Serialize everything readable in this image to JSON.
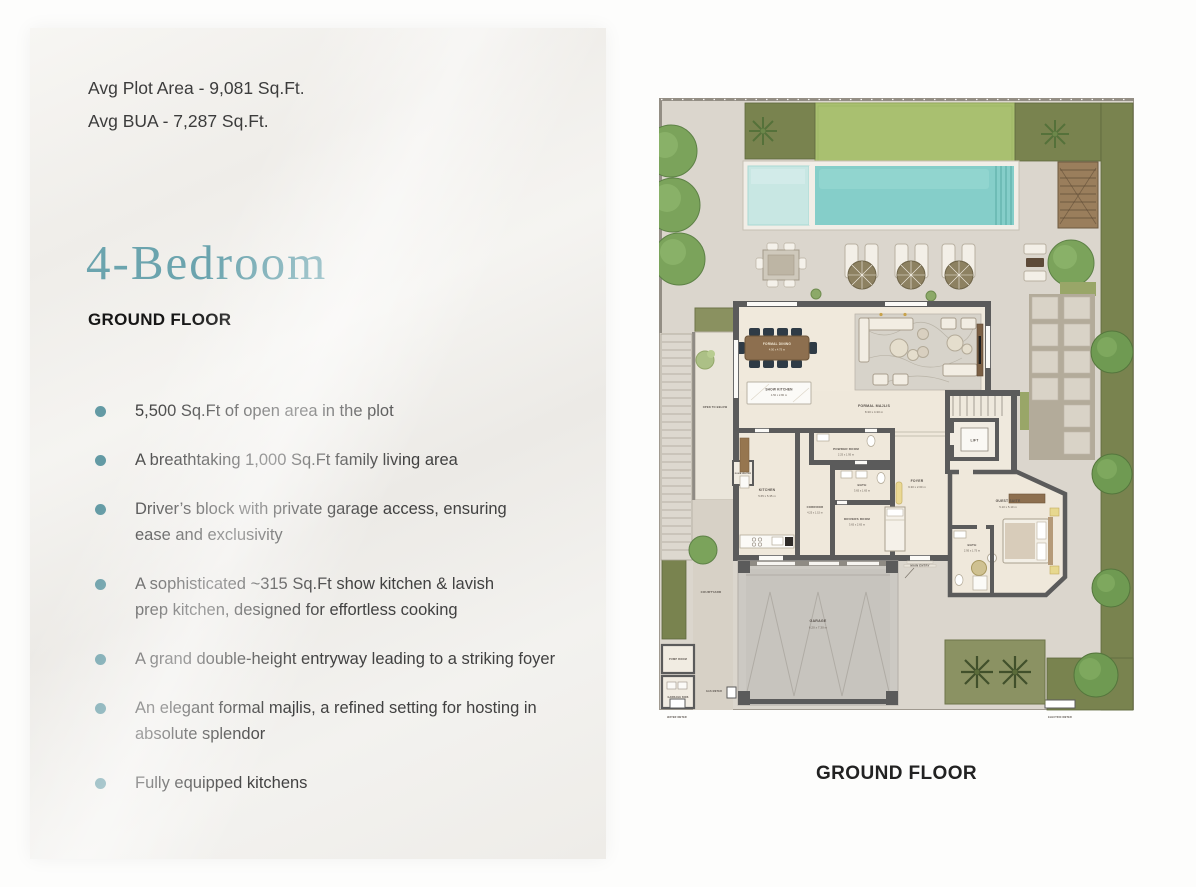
{
  "panel": {
    "stats": {
      "plot_area": "Avg Plot Area - 9,081 Sq.Ft.",
      "bua": "Avg BUA - 7,287 Sq.Ft."
    },
    "title": "4-Bedroom",
    "subtitle": "GROUND FLOOR",
    "bullets": [
      "5,500 Sq.Ft of open area in the plot",
      "A breathtaking 1,000 Sq.Ft family living area",
      "Driver’s block with private garage access, ensuring ease and exclusivity",
      "A sophisticated ~315 Sq.Ft show kitchen & lavish prep kitchen, designed for effortless cooking",
      "A grand double-height entryway leading to a striking foyer",
      "An elegant formal majlis, a refined setting for hosting in absolute splendor",
      "Fully equipped kitchens"
    ]
  },
  "floorplan": {
    "caption": "GROUND FLOOR",
    "rooms": [
      {
        "name": "FORMAL DINING",
        "dim": "4.50 x 4.75 m"
      },
      {
        "name": "SHOW KITCHEN",
        "dim": "4.50 x 2.80 m"
      },
      {
        "name": "FORMAL MAJLIS",
        "dim": "8.30 x 4.30 m"
      },
      {
        "name": "POWDER ROOM",
        "dim": "2.25 x 1.95 m"
      },
      {
        "name": "KITCHEN",
        "dim": "5.65 x 5.35 m"
      },
      {
        "name": "BATH",
        "dim": "3.65 x 1.65 m"
      },
      {
        "name": "CORRIDOR",
        "dim": "4.25 x 1.15 m"
      },
      {
        "name": "DRIVERS ROOM",
        "dim": "3.65 x 2.65 m"
      },
      {
        "name": "FOYER",
        "dim": "6.30 x 2.60 m"
      },
      {
        "name": "GUEST SUITE",
        "dim": "5.10 x 5.10 m"
      },
      {
        "name": "BATH",
        "dim": "2.95 x 1.75 m"
      },
      {
        "name": "GARAGE",
        "dim": "6.20 x 7.30 m"
      },
      {
        "name": "LIFT"
      },
      {
        "name": "OPEN TO BELOW"
      },
      {
        "name": "COURTYARD"
      },
      {
        "name": "MAIN ENTRY"
      },
      {
        "name": "DUMB WAITER"
      },
      {
        "name": "PUMP ROOM"
      },
      {
        "name": "GARBAGE BINS"
      },
      {
        "name": "GAS METER"
      },
      {
        "name": "WATER METER"
      },
      {
        "name": "ELECTRIC METER"
      }
    ],
    "colors": {
      "accent_teal": "#6ba4ae",
      "bullet_dot": "#639aa4",
      "pool_water": "#85cec9",
      "lawn_green": "#a9c070",
      "hedge_green": "#79834f",
      "wall_gray": "#5b5b5b"
    }
  }
}
